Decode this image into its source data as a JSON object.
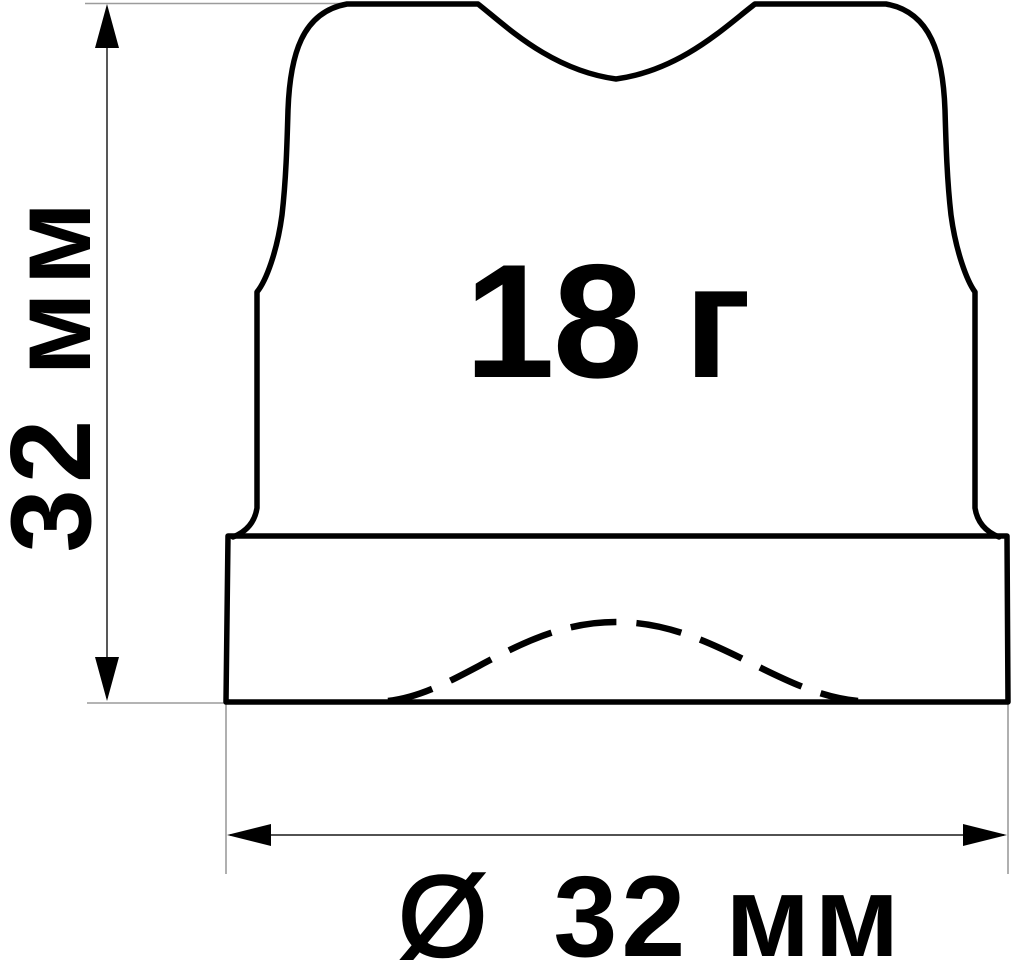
{
  "drawing": {
    "weight_label": "18 г",
    "dimensions": {
      "height_label": "32 мм",
      "diameter_symbol": "Ø",
      "diameter_label": "32 мм"
    }
  },
  "colors": {
    "background": "#ffffff",
    "outline": "#000000",
    "hidden_line": "#000000",
    "extension_line": "#9c9c9c",
    "dimension_line": "#3a3a3a",
    "arrowhead": "#000000",
    "text": "#000000"
  }
}
